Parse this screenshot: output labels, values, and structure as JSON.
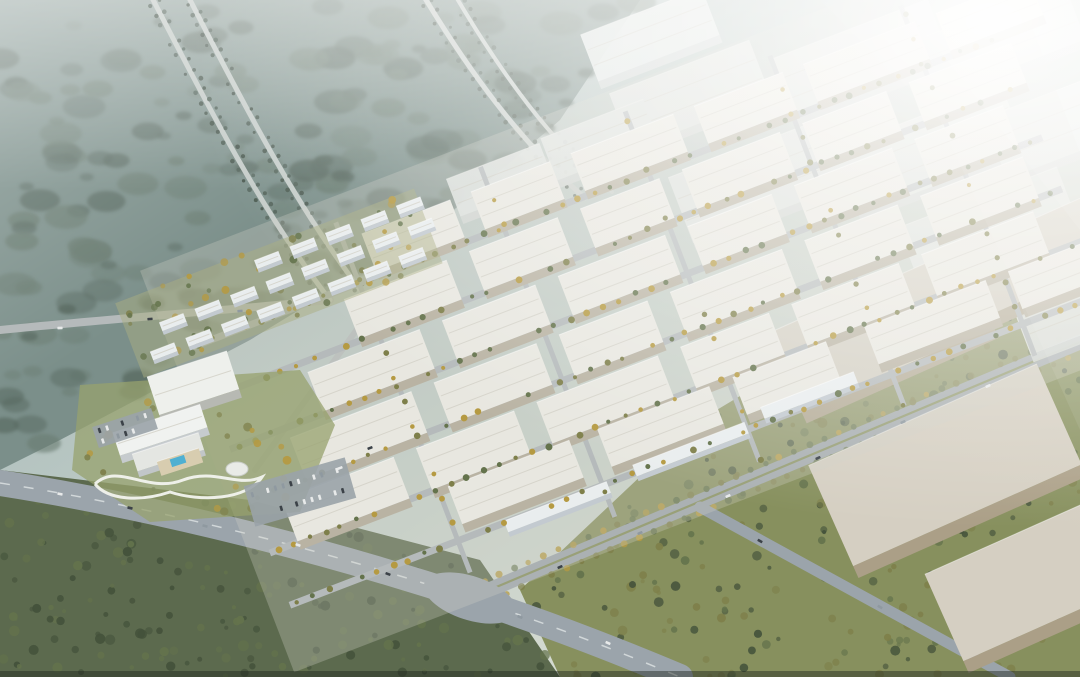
{
  "description": "Aerial architectural rendering of an industrial logistics park: grid of white gabled warehouses with yellow street trees, residential slab blocks, hotel complex with pool and looping garden path, wide grey arterial roads and junction, beige warehouses in green meadow at right, misty forest with diagonal corridors at upper left, bright sun haze from upper right",
  "palette": {
    "sky_top": "#9db1b4",
    "sky_mid": "#c3cfc8",
    "sky_warm": "#e9e7da",
    "glow_warm": "#f5ecd6",
    "forest_nw_base": "#7b8f8a",
    "forest_nw_dark": "#57675e",
    "forest_nw_mid": "#6b7d72",
    "forest_sw_base": "#5c6a4e",
    "tree_dark": "#44523b",
    "tree_mid": "#64734c",
    "tree_olive": "#7e7f4a",
    "tree_yellow": "#b59a42",
    "meadow": "#87905e",
    "park_ground": "#cfd2c6",
    "road": "#9ba4ab",
    "road_light": "#b5babb",
    "road_dark": "#82898f",
    "lane": "#e8ecec",
    "corridor": "#c6cdca",
    "median": "#7f8a4e",
    "roof_white": "#e8e7e0",
    "roof_ridge": "#d2d0c6",
    "wall_warm": "#b9b3a3",
    "roof_pale": "#e2e7e6",
    "wall_pale": "#d0d6d5",
    "roof_beige": "#d5cfc2",
    "wall_beige": "#ab9f87",
    "res_white": "#e9edee",
    "res_face": "#c3cad0",
    "res_ground": "#a9ae82",
    "hotel_green": "#97a26d",
    "pool": "#4fb0d2",
    "path": "#f2f3ee",
    "parking": "#9aa3a8",
    "car_light": "#e8eaea",
    "car_dark": "#3c4248",
    "car_mid": "#8f99a0",
    "bottom_edge": "#20261f"
  },
  "scene": {
    "seed": 97,
    "forest_nw": {
      "poly": [
        [
          0,
          0
        ],
        [
          640,
          0
        ],
        [
          560,
          120
        ],
        [
          430,
          230
        ],
        [
          250,
          340
        ],
        [
          60,
          440
        ],
        [
          0,
          470
        ]
      ],
      "clumps": 175
    },
    "forest_sw": {
      "poly": [
        [
          0,
          470
        ],
        [
          250,
          500
        ],
        [
          480,
          560
        ],
        [
          560,
          677
        ],
        [
          0,
          677
        ]
      ],
      "trees": 175
    },
    "meadow_se": {
      "poly": [
        [
          560,
          677
        ],
        [
          520,
          590
        ],
        [
          700,
          420
        ],
        [
          900,
          300
        ],
        [
          1080,
          260
        ],
        [
          1080,
          677
        ]
      ],
      "trees": 260
    },
    "roads": [
      {
        "id": "boulevard",
        "d": "M0,483 C160,508 330,552 470,598 C560,628 620,652 680,677",
        "w": 26,
        "color": "road",
        "dash_center": true
      },
      {
        "id": "frontage",
        "d": "M470,598 L1080,342",
        "w": 15,
        "color": "road",
        "median": true,
        "trees": true
      },
      {
        "id": "se-branch",
        "d": "M700,507 L1010,677",
        "w": 11,
        "color": "road"
      },
      {
        "id": "west-access",
        "d": "M0,330 C120,318 230,310 330,300",
        "w": 8,
        "color": "road_light"
      },
      {
        "id": "park-edge",
        "d": "M255,470 L445,208",
        "w": 6,
        "color": "road_light"
      },
      {
        "id": "corridor-a1",
        "d": "M148,-10 C210,110 262,212 330,300",
        "w": 5,
        "color": "corridor",
        "side_trees": true
      },
      {
        "id": "corridor-a2",
        "d": "M185,-10 C247,112 300,212 365,296",
        "w": 5,
        "color": "corridor",
        "side_trees": true
      },
      {
        "id": "corridor-b1",
        "d": "M420,-10 C468,70 520,142 585,198",
        "w": 5,
        "color": "corridor",
        "side_trees": true
      },
      {
        "id": "corridor-b2",
        "d": "M452,-10 C500,72 552,144 612,192",
        "w": 4,
        "color": "corridor",
        "side_trees": true
      }
    ],
    "junction": {
      "cx": 470,
      "cy": 598,
      "rx": 48,
      "ry": 22,
      "angle": 18
    },
    "haze_warehouses": {
      "angle": -21,
      "boxes": [
        [
          690,
          95,
          150,
          60
        ],
        [
          860,
          60,
          170,
          65
        ],
        [
          1000,
          40,
          160,
          60
        ],
        [
          760,
          180,
          170,
          70
        ],
        [
          930,
          150,
          180,
          70
        ],
        [
          1070,
          120,
          160,
          65
        ],
        [
          990,
          230,
          170,
          70
        ],
        [
          1090,
          300,
          150,
          60
        ],
        [
          650,
          35,
          130,
          50
        ],
        [
          600,
          140,
          110,
          45
        ],
        [
          500,
          180,
          100,
          40
        ]
      ]
    },
    "beige_warehouses": {
      "angle": -24,
      "boxes": [
        [
          880,
          330,
          210,
          85
        ],
        [
          945,
          465,
          250,
          110
        ],
        [
          1040,
          575,
          210,
          95
        ],
        [
          1050,
          250,
          170,
          70
        ]
      ]
    },
    "industrial": {
      "x": 300,
      "y": 520,
      "angle": -21,
      "ground": [
        -60,
        -290,
        920,
        430
      ],
      "v_streets": [
        140,
        295,
        450,
        605,
        745
      ],
      "v_range": [
        -265,
        110
      ],
      "h_streets": [
        -200,
        -146,
        -91,
        -36,
        20,
        76
      ],
      "h_range": [
        -40,
        830
      ],
      "tree_step": 17,
      "rows": [
        {
          "y": -245,
          "d": 40,
          "buildings": [
            [
              160,
              95
            ],
            [
              277,
              85
            ],
            [
              384,
              110
            ],
            [
              516,
              95
            ],
            [
              633,
              120
            ],
            [
              775,
              100
            ]
          ]
        },
        {
          "y": -190,
          "d": 42,
          "buildings": [
            [
              120,
              110
            ],
            [
              254,
              95
            ],
            [
              373,
              85
            ],
            [
              482,
              105
            ],
            [
              611,
              90
            ],
            [
              725,
              110
            ]
          ]
        },
        {
          "y": -135,
          "d": 42,
          "buildings": [
            [
              60,
              120
            ],
            [
              204,
              100
            ],
            [
              328,
              115
            ],
            [
              467,
              90
            ],
            [
              581,
              105
            ],
            [
              710,
              95
            ]
          ]
        },
        {
          "y": -80,
          "d": 44,
          "buildings": [
            [
              20,
              130
            ],
            [
              174,
              110
            ],
            [
              308,
              95
            ],
            [
              427,
              120
            ],
            [
              571,
              100
            ],
            [
              695,
              110
            ]
          ]
        },
        {
          "y": -25,
          "d": 44,
          "buildings": [
            [
              -10,
              120
            ],
            [
              134,
              105
            ],
            [
              263,
              130
            ],
            [
              417,
              95
            ],
            [
              536,
              115
            ],
            [
              675,
              120
            ]
          ]
        },
        {
          "y": 22,
          "d": 40,
          "buildings": [
            [
              150,
              130
            ],
            [
              310,
              120
            ],
            [
              455,
              100
            ],
            [
              596,
              130
            ],
            [
              750,
              110
            ]
          ]
        }
      ],
      "slabs": [
        [
          190,
          74,
          110
        ],
        [
          330,
          68,
          120
        ],
        [
          470,
          60,
          100
        ]
      ]
    },
    "residential": {
      "x": 150,
      "y": 352,
      "angle": -21,
      "slab_w": 26,
      "slab_d": 9,
      "ground": [
        -15,
        -58,
        320,
        80
      ],
      "ground_trees": 55,
      "rows": [
        {
          "y": 0,
          "xs": [
            0,
            38,
            76,
            114,
            152,
            190,
            228,
            266
          ]
        },
        {
          "y": -24,
          "xs": [
            19,
            57,
            95,
            133,
            171,
            209,
            247,
            285
          ]
        },
        {
          "y": -48,
          "xs": [
            130,
            168,
            206,
            244,
            282
          ]
        }
      ]
    },
    "hotel_area": {
      "green": [
        [
          80,
          385
        ],
        [
          300,
          370
        ],
        [
          335,
          425
        ],
        [
          300,
          512
        ],
        [
          150,
          522
        ],
        [
          72,
          470
        ]
      ],
      "yellow_trees": 26,
      "expo": [
        193,
        383,
        84,
        40,
        -18
      ],
      "hotel_main": [
        160,
        430,
        92,
        24,
        -18
      ],
      "hotel_low": [
        168,
        452,
        70,
        18,
        -18
      ],
      "terrace": [
        180,
        462,
        44,
        15,
        -18
      ],
      "pool": [
        178,
        461,
        15,
        8,
        -18
      ],
      "dome": [
        237,
        469,
        11,
        7
      ],
      "path": "M95,484 C118,462 148,494 183,480 C215,468 238,488 262,477 C247,500 200,502 170,492 C140,502 108,500 95,484",
      "parkings": [
        [
          125,
          428,
          62,
          22,
          -18
        ],
        [
          300,
          492,
          105,
          42,
          -16
        ]
      ]
    },
    "cars": [
      [
        60,
        494,
        12
      ],
      [
        130,
        508,
        13
      ],
      [
        205,
        526,
        15
      ],
      [
        298,
        545,
        17
      ],
      [
        388,
        574,
        20
      ],
      [
        520,
        617,
        22
      ],
      [
        608,
        643,
        24
      ],
      [
        560,
        567,
        -23
      ],
      [
        640,
        533,
        -23
      ],
      [
        728,
        496,
        -23
      ],
      [
        818,
        458,
        -23
      ],
      [
        903,
        422,
        -23
      ],
      [
        988,
        386,
        -23
      ],
      [
        760,
        541,
        29
      ],
      [
        880,
        607,
        29
      ],
      [
        60,
        328,
        -3
      ],
      [
        150,
        319,
        -4
      ],
      [
        240,
        311,
        -4
      ],
      [
        340,
        468,
        -21
      ],
      [
        370,
        448,
        -21
      ]
    ]
  }
}
